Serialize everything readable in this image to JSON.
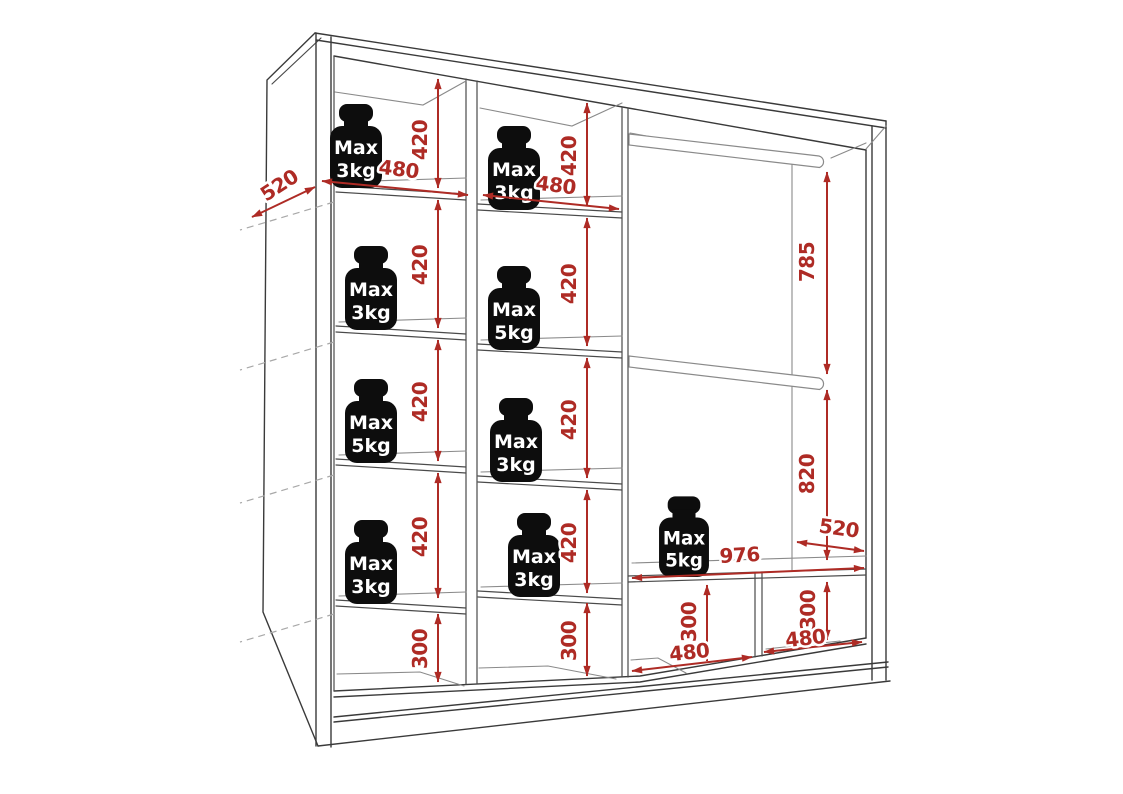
{
  "diagram": {
    "kind": "wardrobe-interior-dimension-drawing",
    "background": "#ffffff"
  },
  "colors": {
    "dimension_red": "#ae2b25",
    "outline_dark": "#3a3a3a",
    "outline_light": "#8a8a8a",
    "weight_black": "#0d0d0d",
    "weight_text": "#ffffff"
  },
  "dimensions": {
    "depth_top_left": "520",
    "column1": {
      "width": "480",
      "row_heights": [
        "420",
        "420",
        "420",
        "420"
      ],
      "bottom_height": "300"
    },
    "column2": {
      "width": "480",
      "row_heights": [
        "420",
        "420",
        "420",
        "420"
      ],
      "bottom_height": "300"
    },
    "hanging_section": {
      "upper_height": "785",
      "lower_height": "820",
      "depth": "520",
      "shelf_width": "976",
      "bottom_left_height": "300",
      "bottom_left_width": "480",
      "bottom_right_height": "300",
      "bottom_right_width": "480"
    }
  },
  "weights": [
    {
      "location": "column1-row1",
      "line1": "Max",
      "line2": "3kg"
    },
    {
      "location": "column2-row1",
      "line1": "Max",
      "line2": "3kg"
    },
    {
      "location": "column1-row2",
      "line1": "Max",
      "line2": "3kg"
    },
    {
      "location": "column2-row2",
      "line1": "Max",
      "line2": "5kg"
    },
    {
      "location": "column1-row3",
      "line1": "Max",
      "line2": "5kg"
    },
    {
      "location": "column2-row3",
      "line1": "Max",
      "line2": "3kg"
    },
    {
      "location": "column1-row4",
      "line1": "Max",
      "line2": "3kg"
    },
    {
      "location": "column2-row4",
      "line1": "Max",
      "line2": "3kg"
    },
    {
      "location": "hanging-section-shelf",
      "line1": "Max",
      "line2": "5kg"
    }
  ]
}
